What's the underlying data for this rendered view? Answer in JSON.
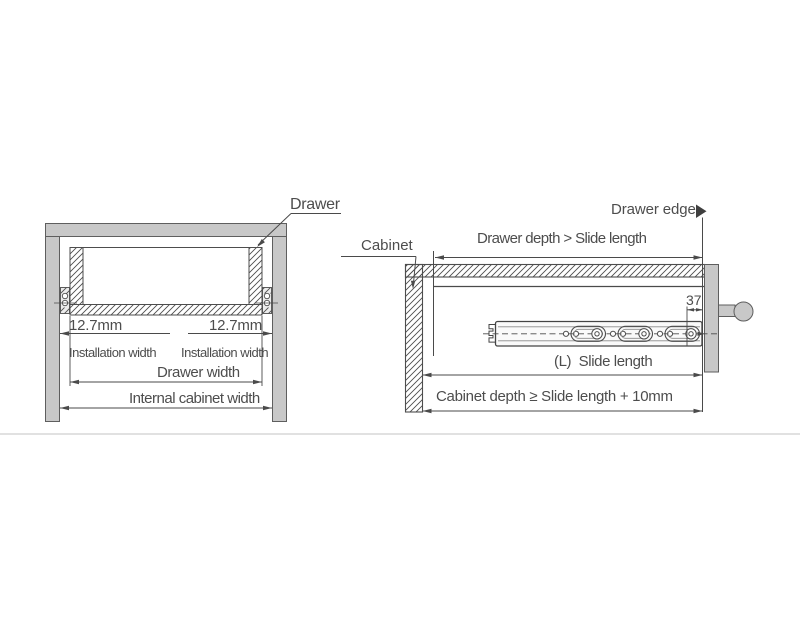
{
  "figure": {
    "type": "technical-drawing",
    "subject": "drawer slide installation dimensions",
    "views": [
      "front section view",
      "side section view"
    ]
  },
  "left_view": {
    "drawer": "Drawer",
    "offset_left": "12.7mm",
    "offset_right": "12.7mm",
    "installation_width_left": "Installation width",
    "installation_width_right": "Installation width",
    "drawer_width": "Drawer width",
    "internal_cabinet_width": "Internal cabinet width"
  },
  "side_view": {
    "cabinet": "Cabinet",
    "drawer_edge": "Drawer edge",
    "drawer_depth_rule": "Drawer depth > Slide length",
    "rear_offset": "37",
    "slide_length": "(L)  Slide length",
    "cabinet_depth_rule": "Cabinet depth ≥ Slide length + 10mm"
  },
  "icons": {
    "drawer_edge_arrow": "right-pointing-triangle"
  },
  "colors": {
    "line": "#4a4a4a",
    "text": "#4d4d4d",
    "panel_fill": "#c8c8c8",
    "panel_stroke": "#5e5e5e",
    "divider": "#e1e1e1",
    "background": "#ffffff"
  }
}
